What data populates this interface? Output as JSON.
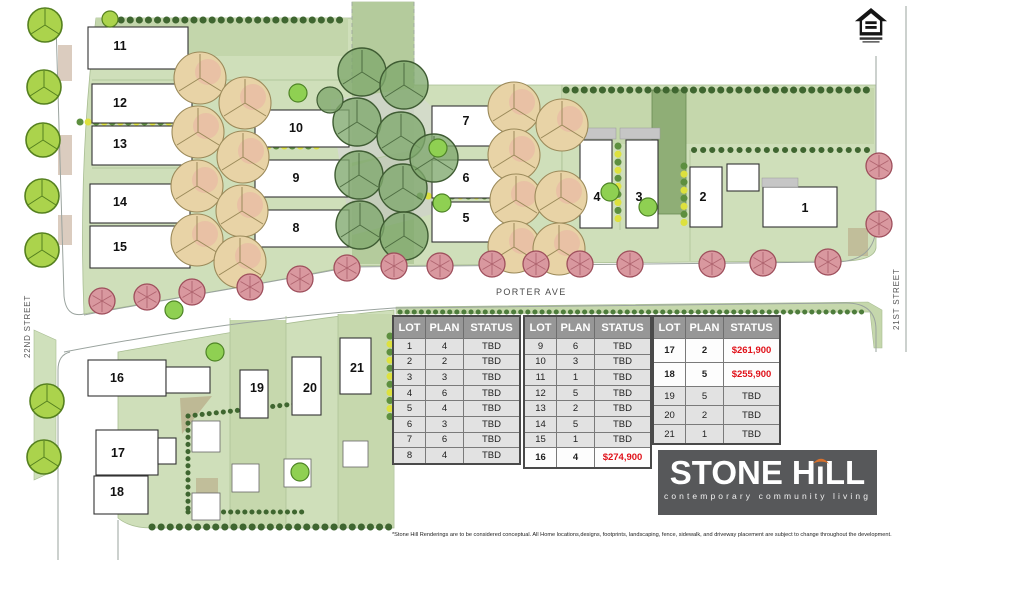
{
  "map": {
    "lots": [
      "1",
      "2",
      "3",
      "4",
      "5",
      "6",
      "7",
      "8",
      "9",
      "10",
      "11",
      "12",
      "13",
      "14",
      "15",
      "16",
      "17",
      "18",
      "19",
      "20",
      "21"
    ],
    "streets": {
      "porter": "PORTER AVE",
      "street_21": "21ST STREET",
      "street_22": "22ND STREET"
    }
  },
  "tables": [
    {
      "headers": [
        "LOT",
        "PLAN",
        "STATUS"
      ],
      "rows": [
        {
          "lot": "1",
          "plan": "4",
          "status": "TBD",
          "sold": false
        },
        {
          "lot": "2",
          "plan": "2",
          "status": "TBD",
          "sold": false
        },
        {
          "lot": "3",
          "plan": "3",
          "status": "TBD",
          "sold": false
        },
        {
          "lot": "4",
          "plan": "6",
          "status": "TBD",
          "sold": false
        },
        {
          "lot": "5",
          "plan": "4",
          "status": "TBD",
          "sold": false
        },
        {
          "lot": "6",
          "plan": "3",
          "status": "TBD",
          "sold": false
        },
        {
          "lot": "7",
          "plan": "6",
          "status": "TBD",
          "sold": false
        },
        {
          "lot": "8",
          "plan": "4",
          "status": "TBD",
          "sold": false
        }
      ]
    },
    {
      "headers": [
        "LOT",
        "PLAN",
        "STATUS"
      ],
      "rows": [
        {
          "lot": "9",
          "plan": "6",
          "status": "TBD",
          "sold": false
        },
        {
          "lot": "10",
          "plan": "3",
          "status": "TBD",
          "sold": false
        },
        {
          "lot": "11",
          "plan": "1",
          "status": "TBD",
          "sold": false
        },
        {
          "lot": "12",
          "plan": "5",
          "status": "TBD",
          "sold": false
        },
        {
          "lot": "13",
          "plan": "2",
          "status": "TBD",
          "sold": false
        },
        {
          "lot": "14",
          "plan": "5",
          "status": "TBD",
          "sold": false
        },
        {
          "lot": "15",
          "plan": "1",
          "status": "TBD",
          "sold": false
        },
        {
          "lot": "16",
          "plan": "4",
          "status": "$274,900",
          "sold": true
        }
      ]
    },
    {
      "headers": [
        "LOT",
        "PLAN",
        "STATUS"
      ],
      "rows": [
        {
          "lot": "17",
          "plan": "2",
          "status": "$261,900",
          "sold": true
        },
        {
          "lot": "18",
          "plan": "5",
          "status": "$255,900",
          "sold": true
        },
        {
          "lot": "19",
          "plan": "5",
          "status": "TBD",
          "sold": false
        },
        {
          "lot": "20",
          "plan": "2",
          "status": "TBD",
          "sold": false
        },
        {
          "lot": "21",
          "plan": "1",
          "status": "TBD",
          "sold": false
        }
      ]
    }
  ],
  "logo": {
    "word1": "STONE",
    "h": "H",
    "i": "ı",
    "ll": "LL",
    "tagline": "contemporary community living",
    "arc_color": "#d9712c",
    "bg_color": "#57585a"
  },
  "disclaimer": "*Stone Hill Renderings are to be considered conceptual.  All Home locations,designs, footprints, landscaping, fence, sidewalk, and driveway placement are subject to change throughout the development.",
  "colors": {
    "price_red": "#e01119",
    "table_header_gray": "#979797",
    "table_row_gray": "#e2e2e2",
    "lawn_green": "#cfdfba",
    "street_tree_pink": "#d9989f",
    "canopy_tan": "#e8d3a6",
    "tree_lime": "#abd34c",
    "logo_orange": "#d9712c"
  }
}
